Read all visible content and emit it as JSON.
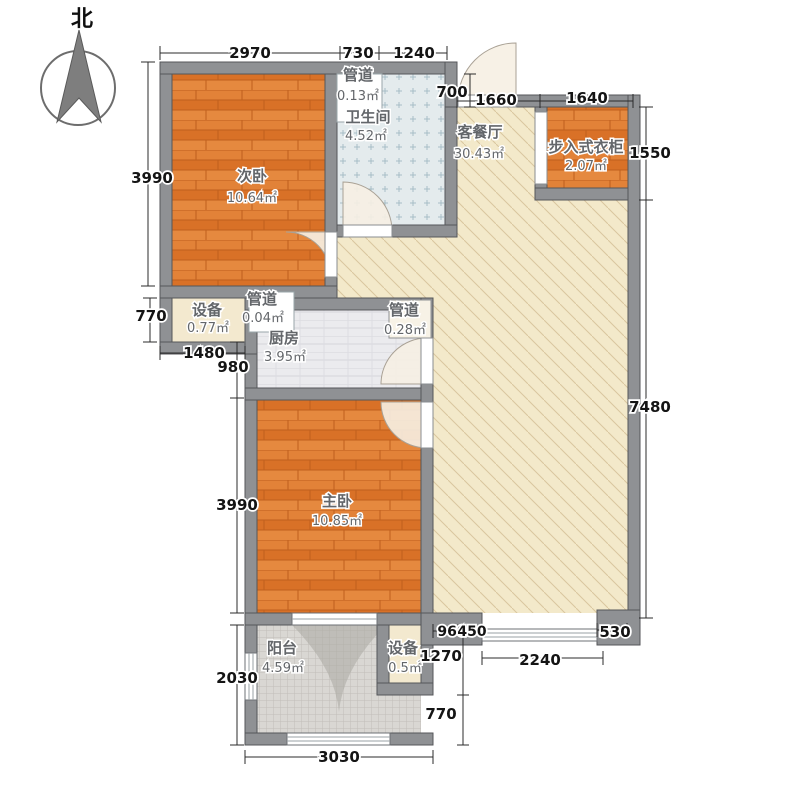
{
  "title": "两室户型平面图",
  "compass": {
    "label": "北"
  },
  "rooms": {
    "secondary_bedroom": {
      "name": "次卧",
      "area": "10.64㎡"
    },
    "duct_top": {
      "name": "管道",
      "area": "0.13㎡"
    },
    "bathroom": {
      "name": "卫生间",
      "area": "4.52㎡"
    },
    "living_dining": {
      "name": "客餐厅",
      "area": "30.43㎡"
    },
    "walk_in_closet": {
      "name": "步入式衣柜",
      "area": "2.07㎡"
    },
    "equipment_left": {
      "name": "设备",
      "area": "0.77㎡"
    },
    "duct_mid": {
      "name": "管道",
      "area": "0.04㎡"
    },
    "kitchen": {
      "name": "厨房",
      "area": "3.95㎡"
    },
    "duct_right": {
      "name": "管道",
      "area": "0.28㎡"
    },
    "master_bedroom": {
      "name": "主卧",
      "area": "10.85㎡"
    },
    "balcony": {
      "name": "阳台",
      "area": "4.59㎡"
    },
    "equipment_bottom": {
      "name": "设备",
      "area": "0.5㎡"
    }
  },
  "dims": {
    "top_1": "2970",
    "top_2": "730",
    "top_3": "1240",
    "entry_step": "700",
    "entry_1": "1660",
    "entry_2": "1640",
    "right_1": "1550",
    "right_2": "7480",
    "left_bedroom2": "3990",
    "left_equip": "770",
    "left_1480": "1480",
    "left_980": "980",
    "left_master": "3990",
    "left_balcony": "2030",
    "bottom_balcony": "3030",
    "br_960": "960",
    "br_450": "450",
    "br_1270": "1270",
    "br_770": "770",
    "br_2240": "2240",
    "br_530": "530"
  }
}
